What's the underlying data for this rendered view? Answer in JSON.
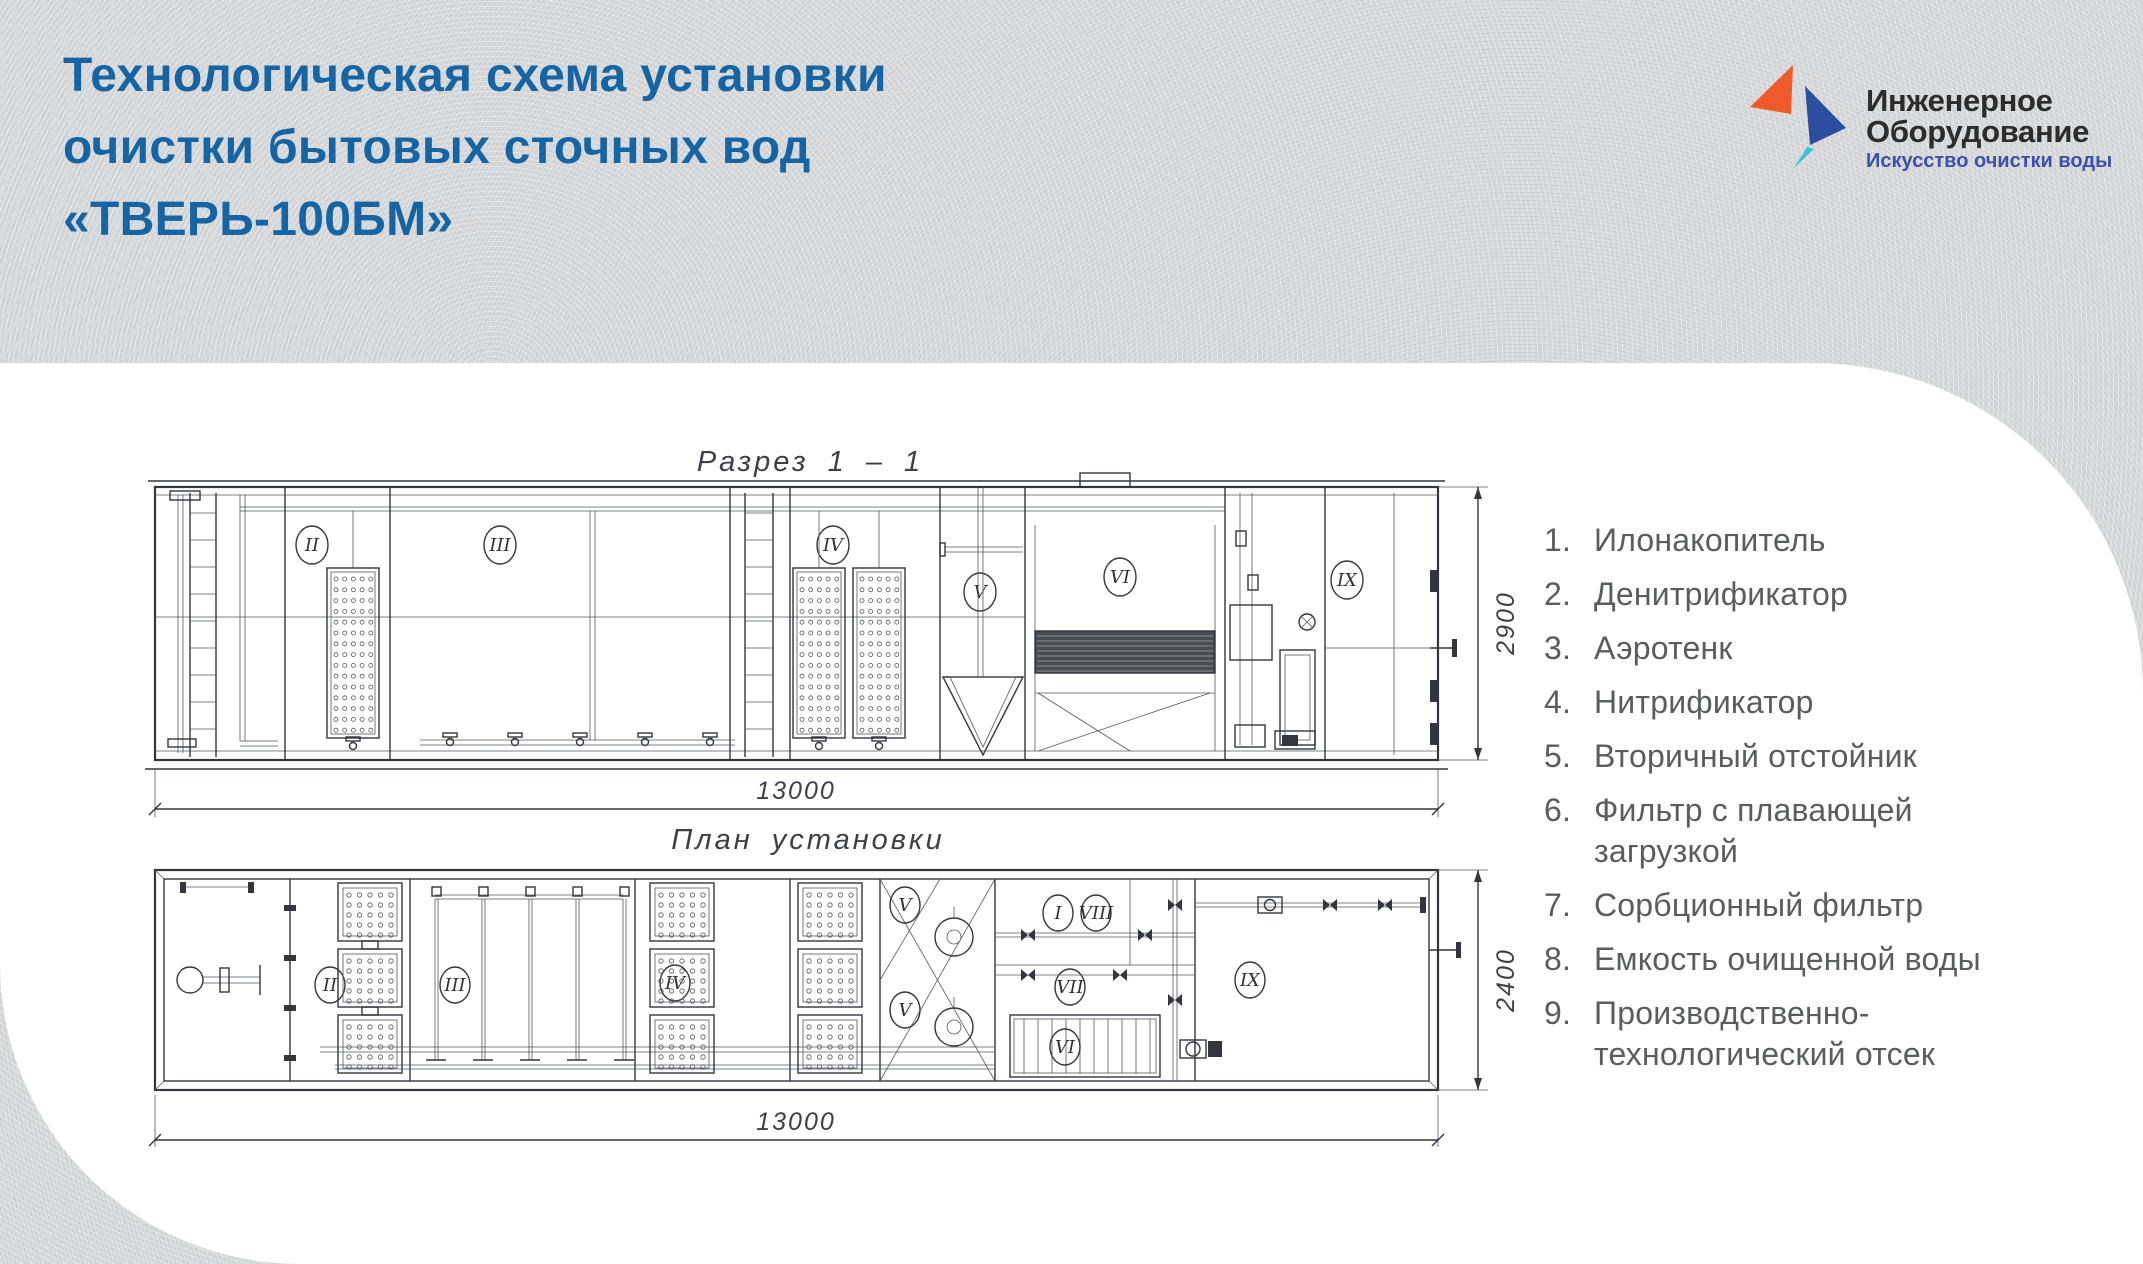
{
  "header": {
    "title_line1": "Технологическая схема установки",
    "title_line2": "очистки бытовых сточных вод",
    "title_line3": "«ТВЕРЬ-100БМ»",
    "title_color": "#1565a4"
  },
  "logo": {
    "name_line1": "Инженерное",
    "name_line2": "Оборудование",
    "tagline": "Искусство очистки воды",
    "colors": {
      "orange": "#f05a2b",
      "blue": "#2c4da0",
      "teal": "#39c4cf",
      "text": "#2c2c2c",
      "tagline": "#3c51a8"
    }
  },
  "drawings": {
    "section": {
      "caption": "Разрез 1 – 1",
      "dim_width": "13000",
      "dim_height": "2900",
      "numerals": [
        "II",
        "III",
        "IV",
        "V",
        "VI",
        "IX"
      ]
    },
    "plan": {
      "caption": "План установки",
      "dim_width": "13000",
      "dim_height": "2400",
      "numerals": [
        "II",
        "III",
        "IV",
        "V",
        "V",
        "I",
        "VIII",
        "VII",
        "VI",
        "IX"
      ]
    }
  },
  "legend": {
    "items": [
      {
        "num": "1.",
        "text": "Илонакопитель"
      },
      {
        "num": "2.",
        "text": "Денитрификатор"
      },
      {
        "num": "3.",
        "text": "Аэротенк"
      },
      {
        "num": "4.",
        "text": "Нитрификатор"
      },
      {
        "num": "5.",
        "text": "Вторичный отстойник"
      },
      {
        "num": "6.",
        "text": "Фильтр с плавающей загрузкой"
      },
      {
        "num": "7.",
        "text": "Сорбционный фильтр"
      },
      {
        "num": "8.",
        "text": "Емкость очищенной воды"
      },
      {
        "num": "9.",
        "text": "Производственно-технологический отсек"
      }
    ]
  }
}
